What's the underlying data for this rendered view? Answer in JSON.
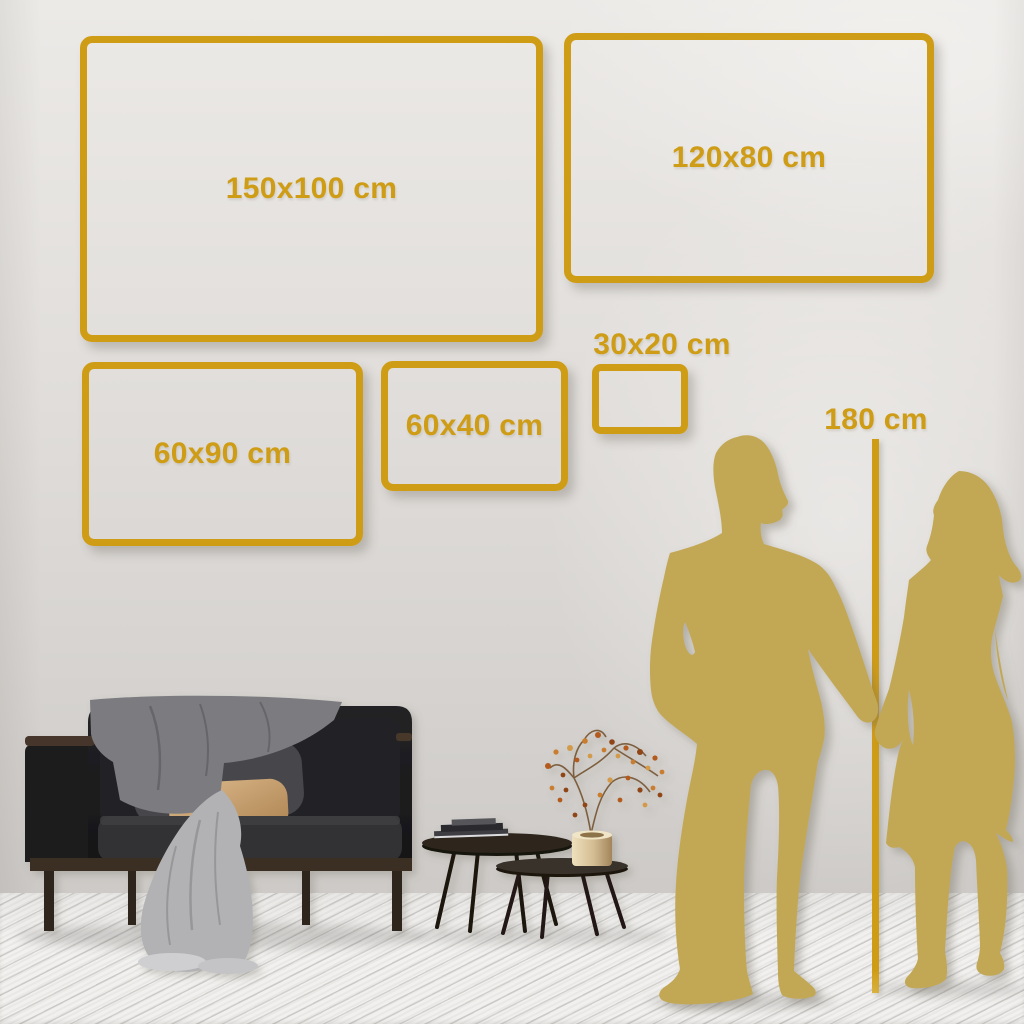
{
  "meta": {
    "title": "Wall art size guide"
  },
  "colors": {
    "gold": "#cf9c16",
    "silhouette_gold": "#c2a855",
    "wall": "#d9d6d3",
    "floor": "#f1f0ee"
  },
  "sizes": [
    {
      "label": "150x100 cm"
    },
    {
      "label": "120x80 cm"
    },
    {
      "label": "60x90 cm"
    },
    {
      "label": "60x40 cm"
    },
    {
      "label": "30x20 cm"
    }
  ],
  "height_reference": {
    "label": "180 cm"
  },
  "scene": {
    "objects": [
      "sofa",
      "throw-blanket",
      "dark-pillow",
      "beige-pillow",
      "coffee-table-large",
      "coffee-table-small",
      "books",
      "brass-vase",
      "dried-branch",
      "man-silhouette",
      "woman-silhouette"
    ]
  }
}
